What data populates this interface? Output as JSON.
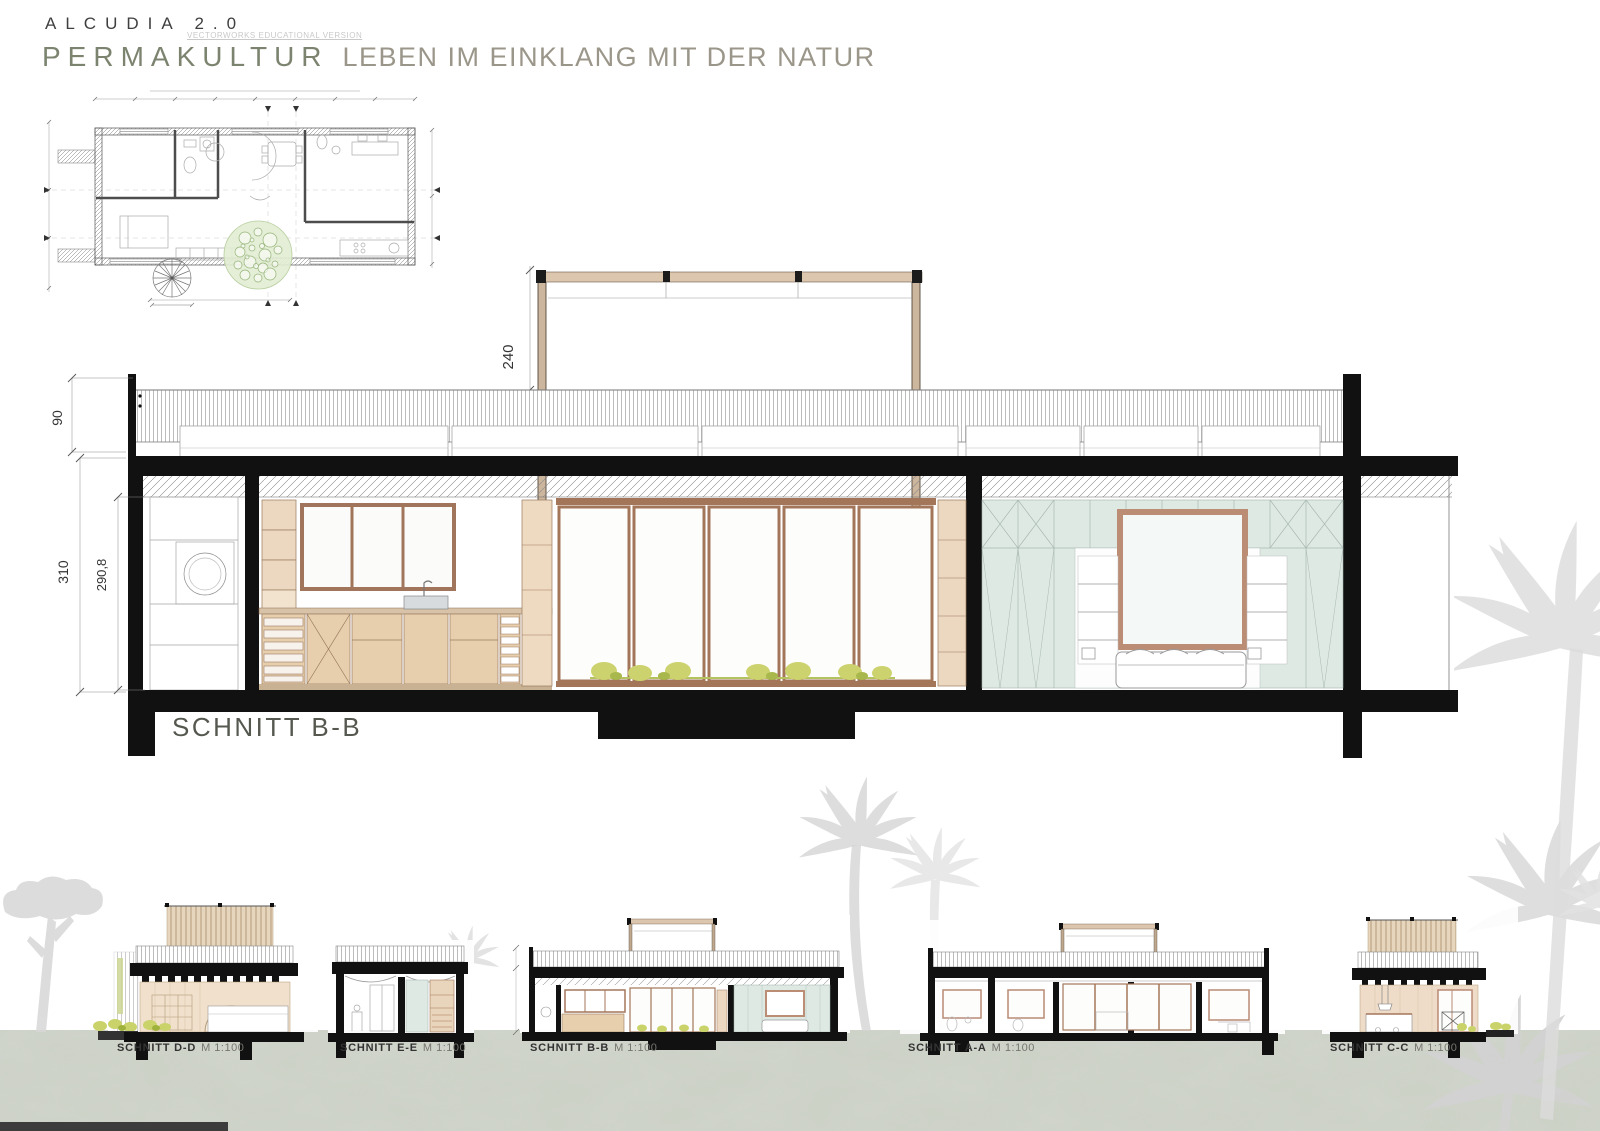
{
  "header": {
    "project": "ALCUDIA 2.0",
    "watermark": "VECTORWORKS EDUCATIONAL VERSION",
    "title": "PERMAKULTUR",
    "subtitle": "LEBEN IM EINKLANG MIT DER NATUR"
  },
  "main_section": {
    "label": "SCHNITT B-B",
    "dim_pergola_height": "240",
    "dim_parapet_height": "90",
    "dim_floor_height": "310",
    "dim_clear_height": "290,8"
  },
  "small_sections": [
    {
      "label": "SCHNITT D-D",
      "scale": "M 1:100"
    },
    {
      "label": "SCHNITT E-E",
      "scale": "M 1:100"
    },
    {
      "label": "SCHNITT B-B",
      "scale": "M 1:100"
    },
    {
      "label": "SCHNITT A-A",
      "scale": "M 1:100"
    },
    {
      "label": "SCHNITT C-C",
      "scale": "M 1:100"
    }
  ],
  "colors": {
    "title_green": "#7c8470",
    "subtitle_gray": "#9b968a",
    "wood_tan": "#e7cfae",
    "frame_brown": "#a3765a",
    "wardrobe_mint": "#dfe9e4",
    "plant_green": "#c9d36a",
    "ground_gray": "#ccd1c6"
  }
}
